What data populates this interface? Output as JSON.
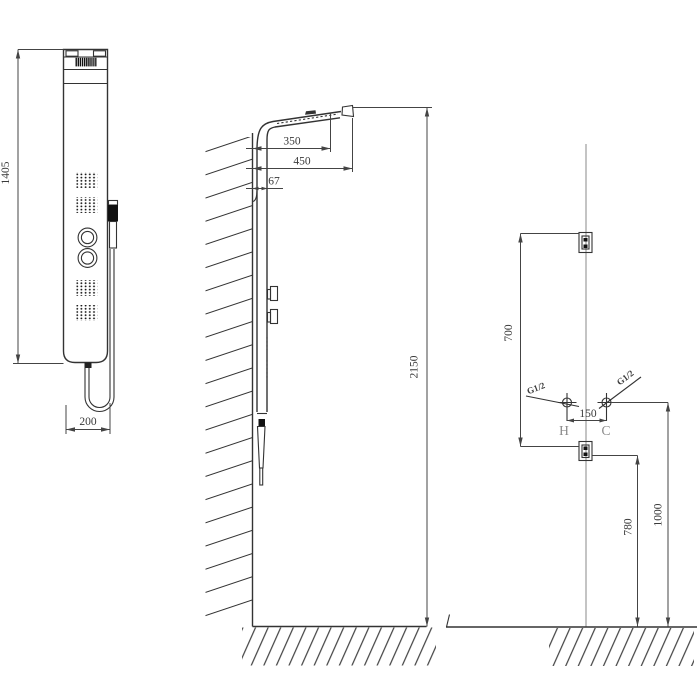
{
  "title": "Shower panel installation technical drawing",
  "views": {
    "front": {
      "height": "1405",
      "width": "200"
    },
    "side": {
      "head_offset": "350",
      "head_reach": "450",
      "panel_depth": "67",
      "install_height": "2150"
    },
    "plumbing": {
      "bracket_span": "700",
      "inlet_spacing": "150",
      "hot": "H",
      "cold": "C",
      "hot_thread": "G1/2",
      "cold_thread": "G1/2",
      "outlet_height": "780",
      "inlet_height": "1000"
    }
  },
  "colors": {
    "line": "#333333",
    "centerline": "#9c9c9c",
    "label_gray": "#8a8a8a",
    "background": "#ffffff"
  }
}
